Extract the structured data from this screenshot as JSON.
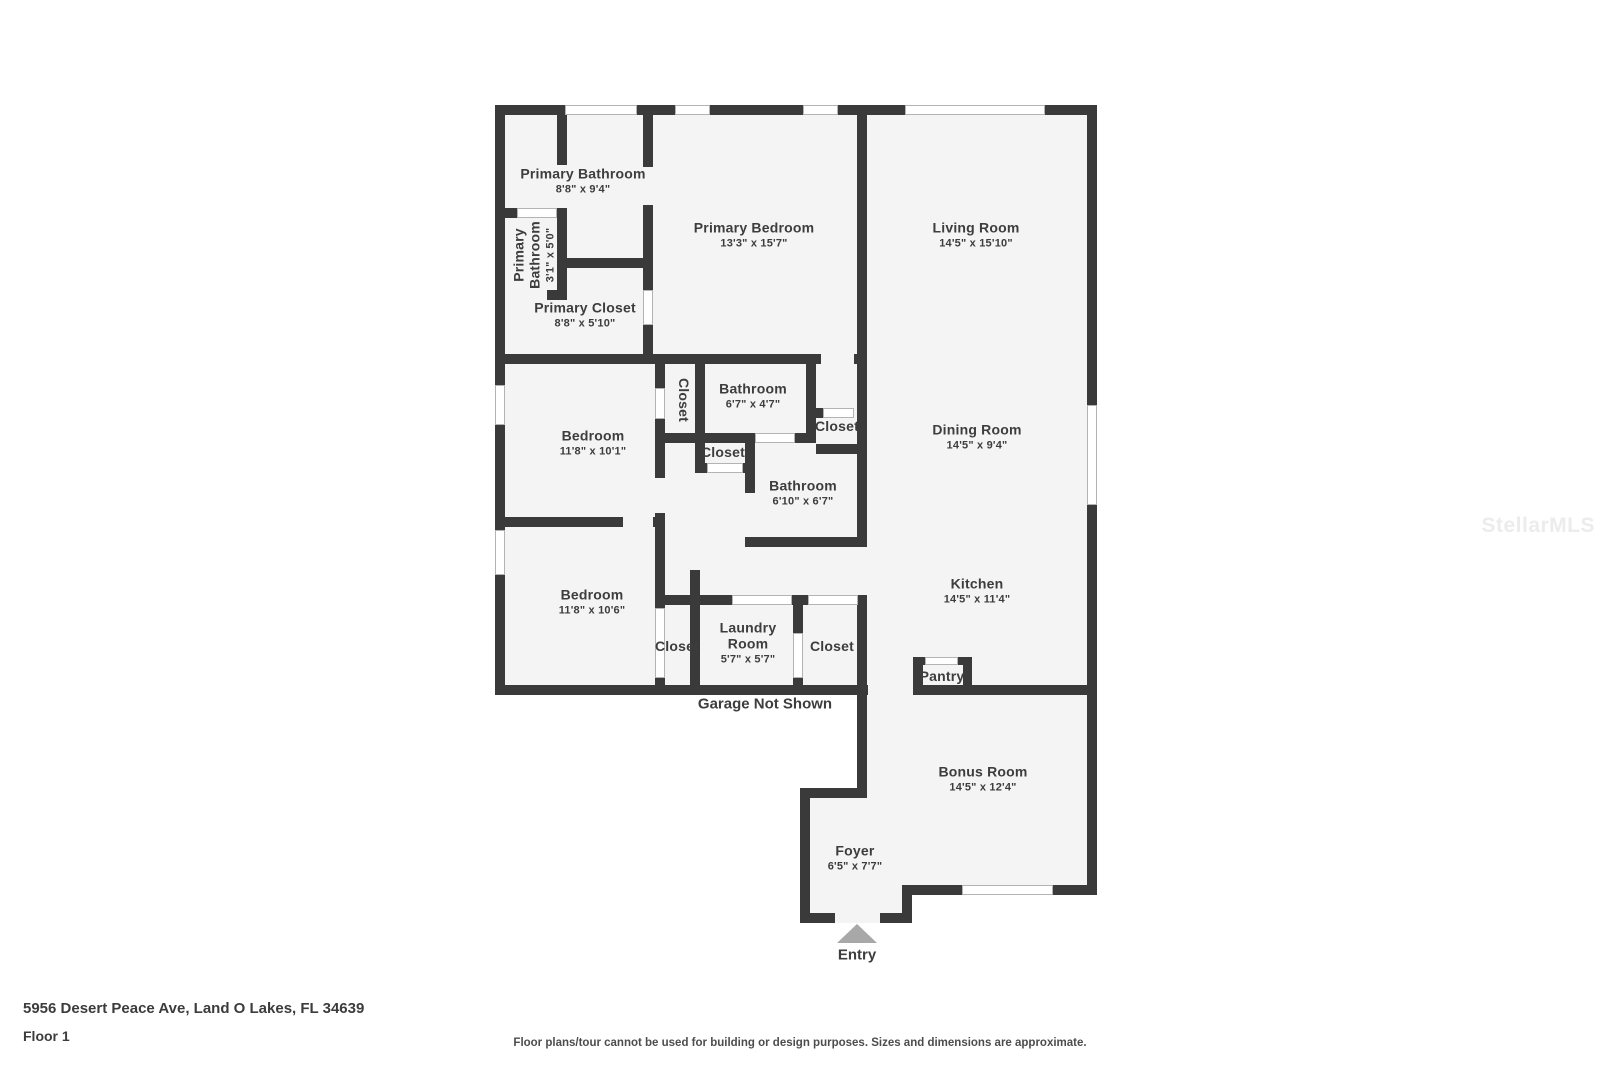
{
  "page": {
    "address": "5956 Desert Peace Ave, Land O Lakes, FL 34639",
    "floor_label": "Floor 1",
    "disclaimer": "Floor plans/tour cannot be used for building or design purposes. Sizes and dimensions are approximate.",
    "watermark": "StellarMLS"
  },
  "floorplan": {
    "annotations": {
      "garage_note": "Garage Not Shown",
      "entry_label": "Entry"
    },
    "rooms": [
      {
        "name": "Primary Bathroom",
        "dims": "8'8\" x 9'4\""
      },
      {
        "name": "Primary Bathroom",
        "dims": "3'1\" x 5'0\""
      },
      {
        "name": "Primary Closet",
        "dims": "8'8\" x 5'10\""
      },
      {
        "name": "Primary Bedroom",
        "dims": "13'3\" x 15'7\""
      },
      {
        "name": "Living Room",
        "dims": "14'5\" x 15'10\""
      },
      {
        "name": "Bedroom",
        "dims": "11'8\" x 10'1\""
      },
      {
        "name": "Closet"
      },
      {
        "name": "Bathroom",
        "dims": "6'7\" x 4'7\""
      },
      {
        "name": "Closet"
      },
      {
        "name": "Closet"
      },
      {
        "name": "Bathroom",
        "dims": "6'10\" x 6'7\""
      },
      {
        "name": "Dining Room",
        "dims": "14'5\" x 9'4\""
      },
      {
        "name": "Bedroom",
        "dims": "11'8\" x 10'6\""
      },
      {
        "name": "Closet"
      },
      {
        "name": "Laundry Room",
        "dims": "5'7\" x 5'7\""
      },
      {
        "name": "Closet"
      },
      {
        "name": "Kitchen",
        "dims": "14'5\" x 11'4\""
      },
      {
        "name": "Pantry"
      },
      {
        "name": "Bonus Room",
        "dims": "14'5\" x 12'4\""
      },
      {
        "name": "Foyer",
        "dims": "6'5\" x 7'7\""
      }
    ],
    "colors": {
      "wall": "#3a3a3a",
      "floor": "#f4f4f4",
      "label": "#3d3d3d",
      "entry_arrow": "#a8a8a8"
    }
  }
}
